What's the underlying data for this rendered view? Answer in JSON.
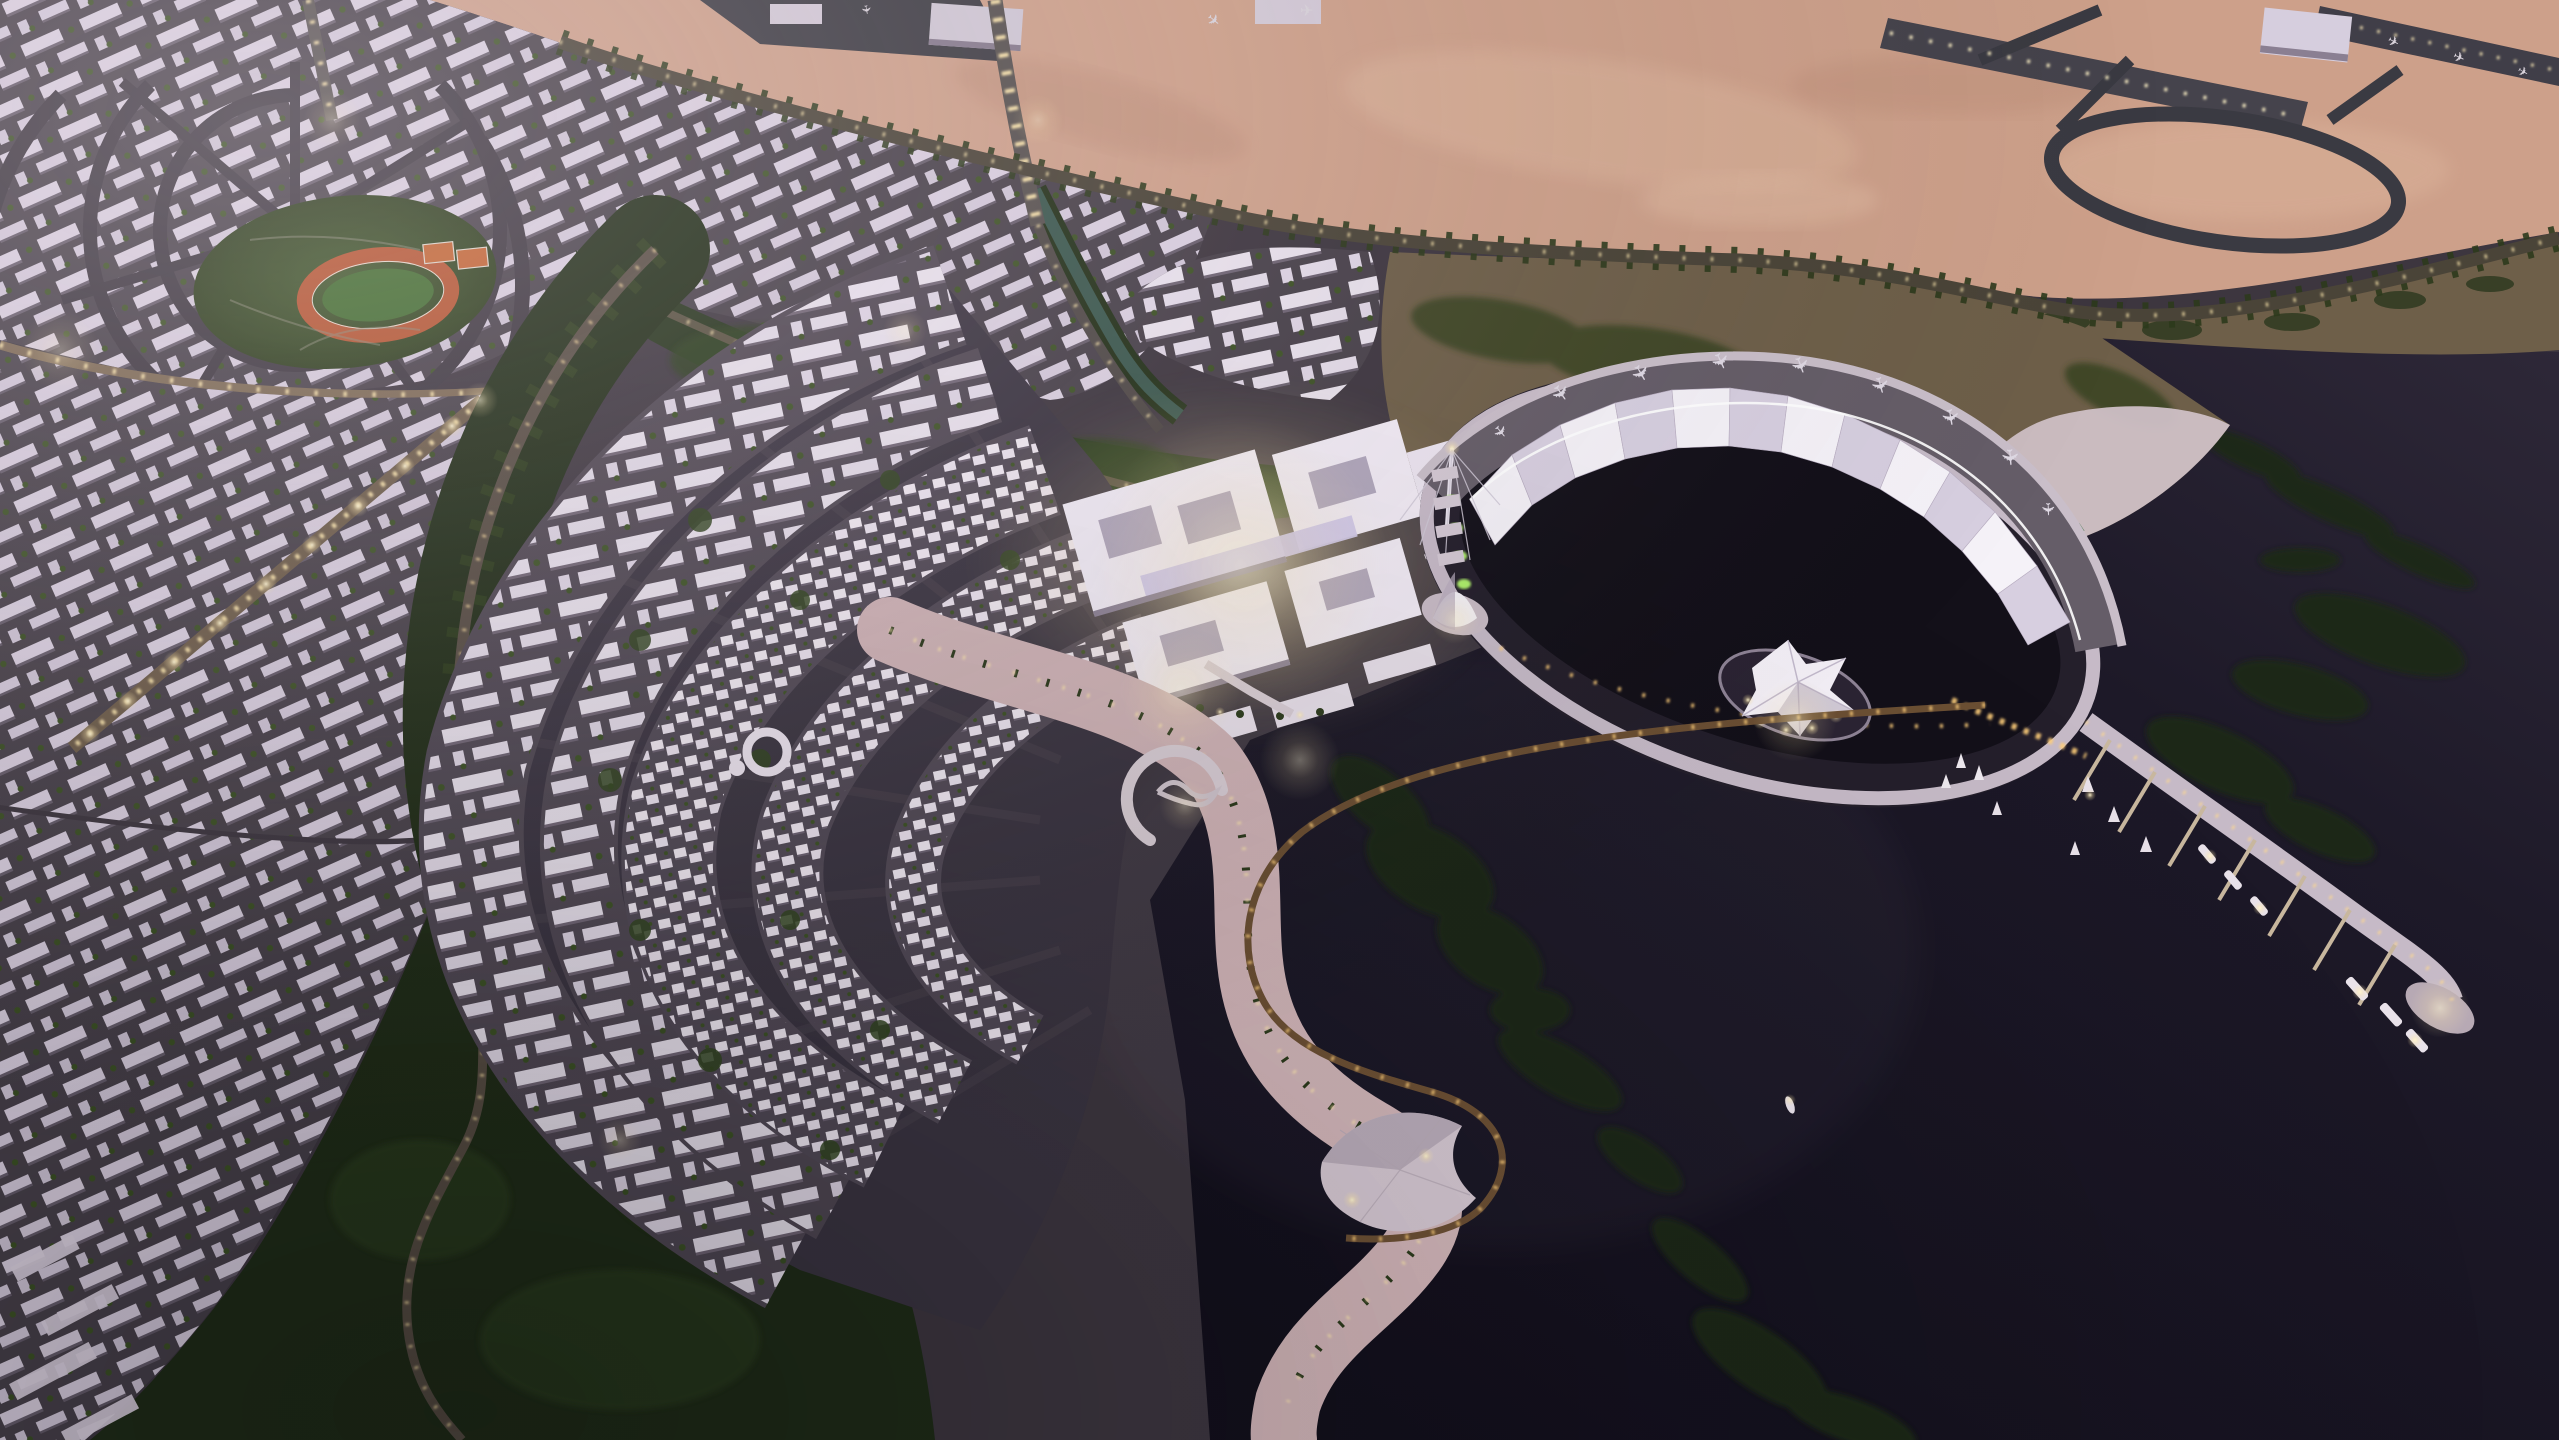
{
  "scene": {
    "description": "Dusk aerial 3D rendering of a coastal desert city masterplan: a crescent-shaped illuminated residential district wraps a dark bay, a white fan-pleated pavilion with aircraft exhibits curves around an oval lagoon peninsula, a marina pier with moored yachts extends into dark water, an airport sits in salmon-colored desert at top right, and dense lavender-roofed housing grids with a circular stadium district fill the left.",
    "time_of_day": "dusk",
    "style": "architectural visualization, aerial oblique view"
  },
  "palette": {
    "sky_haze": "#e8dce4",
    "city_base": "#3d363f",
    "street": "#474049",
    "roof_lavender": "#d9cfdf",
    "roof_bright": "#e9e2ee",
    "villa_white": "#f0e9f2",
    "downtown_white": "#f1ebf5",
    "desert_sand": "#cda08a",
    "desert_light": "#dcb49b",
    "scrub_olive": "#6e5f49",
    "forest_green": "#1f2c16",
    "belt_green": "#24331b",
    "park_green": "#3c5a26",
    "track_orange": "#b5532e",
    "infield_green": "#3f6b2c",
    "court_orange": "#c2622f",
    "water_dark": "#16121f",
    "water_shore": "#2e2838",
    "lagoon_dark": "#131019",
    "canal_teal": "#3c5a50",
    "sand_beach": "#cfb3b6",
    "sand_pale": "#cfc0c6",
    "rim_lavender": "#c6bac7",
    "deck_gray": "#655d68",
    "sail_white": "#f5f2f8",
    "sail_shade": "#d7cfe0",
    "light_warm": "#ffe9ae",
    "light_gold": "#ffcf7a",
    "glow_green": "#aef06a",
    "boat_white": "#e9e2ea",
    "reef_green": "#1d2914"
  },
  "regions": {
    "desert_airport": "desert plain with airport runways, taxiway loop and hangars",
    "coastal_road": "palm-lined illuminated boundary road between desert and city",
    "residential_grid_north": "lavender-roofed perimeter-block housing grid",
    "circular_district": "concentric ring district around a central park",
    "central_park": "park with athletics track and tennis courts",
    "green_belt": "forest belt with lit promenade",
    "downtown": "bright white mixed-use core with courtyards and amphitheater",
    "crescent_district": "arcs of apartments and villa rows around the bay",
    "beach": "pink sand beach with lit promenade and palms",
    "bay": "dark inner bay with lit boardwalk arc and sculpture island",
    "lagoon_pavilion": "oval lagoon peninsula with fan-pleated sail roof and aircraft deck",
    "tent_islands": "crumpled tent pavilion and cone pavilion on lagoon islands",
    "marina": "breakwater pier with finger docks and moored boats",
    "open_water": "dark sea with reef and mangrove patches",
    "forests": "dark parkland with winding lit roads",
    "canal": "teal canal between districts"
  },
  "features": {
    "fan_roof_pleats": 12,
    "aircraft_exhibits": 9,
    "marina_docks": 7,
    "moored_boats": 12,
    "roundabouts": 1,
    "runways": 2,
    "hangars": 3,
    "tent_pavilions": 2,
    "sports_facilities": [
      "athletics track",
      "tennis courts"
    ],
    "lone_boat_in_bay": 1
  }
}
